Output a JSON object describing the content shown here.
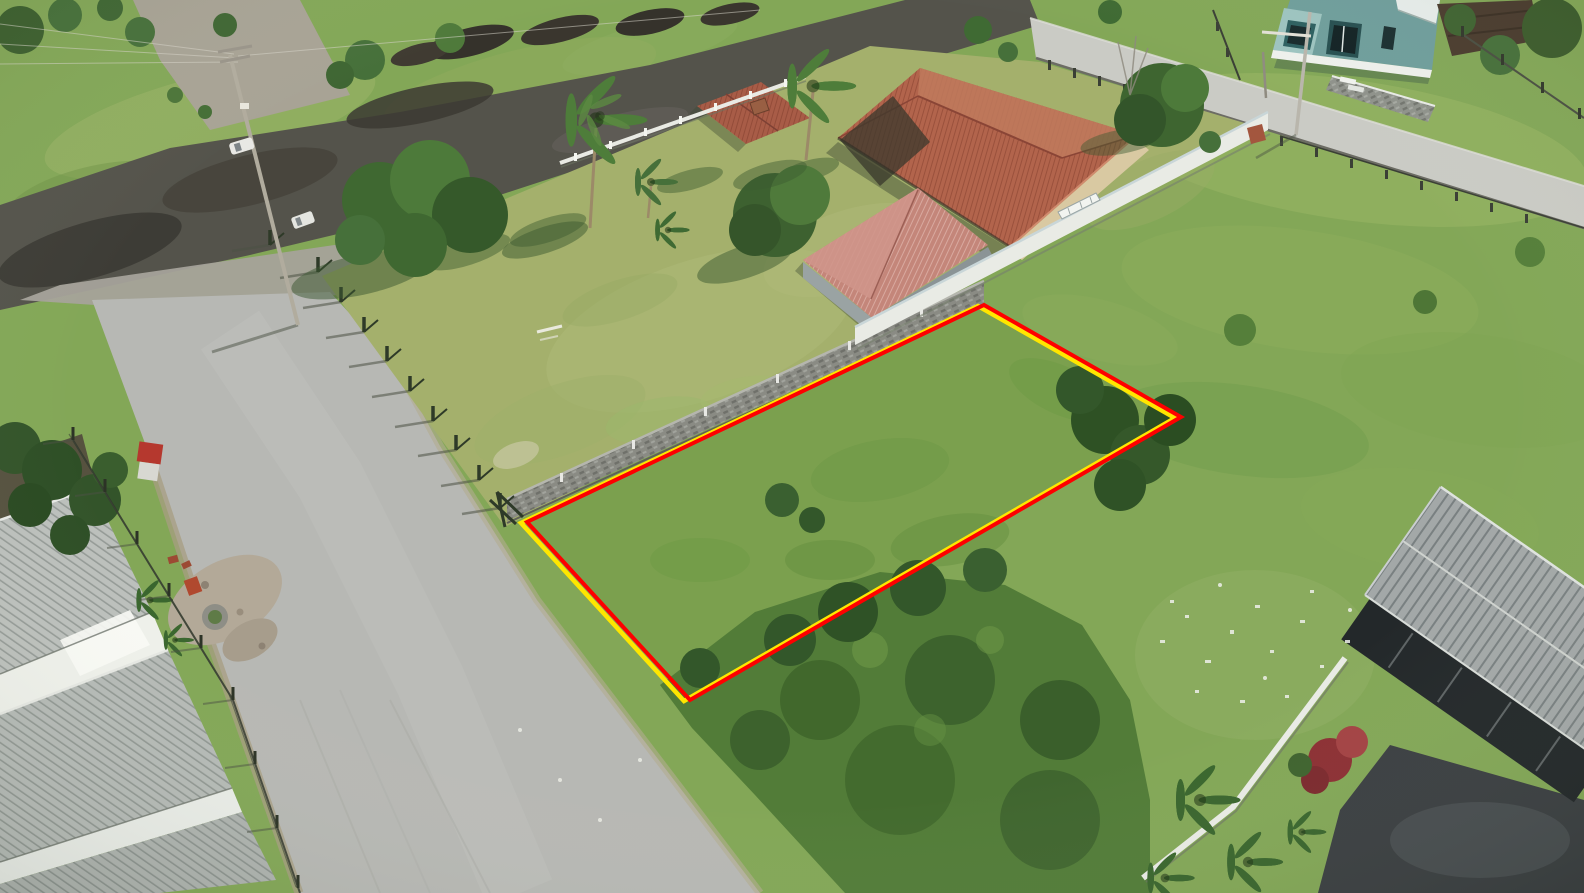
{
  "meta": {
    "type": "aerial-drone-photograph",
    "description": "Bright daytime aerial drone photo of a suburban block: a vacant grassy land plot is highlighted with a double red and yellow quadrilateral outline. A gray residential street runs diagonally past the plot, a dark asphalt road crosses the top, a cream house with terracotta tile roof and a red-roofed shed sit on a lawn behind a gray stone wall and a white wall, a teal modern house sits top-right by a concrete street, gray corrugated row buildings fill the bottom-left corner, and a dark-walled house with gray corrugated roof, driveway and red flowering bush sits bottom-right. Fields of mottled green grass and darker scrub fill the remaining areas.",
    "image_width_px": 1584,
    "image_height_px": 893,
    "visible_text": "none"
  },
  "plot_highlight": {
    "shape": "quadrilateral",
    "outer_line_color": "#ffe600",
    "inner_line_color": "#fe0000",
    "line_width_px": 4,
    "corners_px": {
      "top": [
        984,
        305
      ],
      "right": [
        1181,
        417
      ],
      "bottom": [
        690,
        700
      ],
      "left": [
        527,
        522
      ]
    }
  },
  "palette": {
    "grass_base": "#83a757",
    "field_light": "#9ab468",
    "lawn": "#a4b06c",
    "lot_grass": "#7ba04e",
    "scrub_dark": "#527c38",
    "asphalt_road": "#54534b",
    "street_gray": "#b7b8b4",
    "concrete_street": "#cacbc5",
    "gravel": "#a8a395",
    "dirt_shoulder": "#ab9f85",
    "terracotta_roof": "#b2644c",
    "annex_roof": "#a85c47",
    "shed_roof": "#c4867a",
    "shed_wall": "#9aa3a3",
    "cream_wall": "#d9c9a2",
    "white_wall": "#e9ebe5",
    "stone_wall": "#8a8b84",
    "teal_house": "#6f9e9c",
    "teal_trim": "#2d5f60",
    "gray_roof": "#a3a8a8",
    "rowhouse_roof": "#bcc0bc",
    "dark_facade": "#23282a",
    "driveway": "#3b3f42",
    "tree_dark": "#3f632f",
    "tree_mid": "#557f3c",
    "palm_green": "#4e7d3a",
    "red_bush": "#8c3034",
    "truck_red": "#b5382e",
    "vehicle_white": "#e8e8e4"
  },
  "scene": {
    "objects": [
      "highlighted-plot-outline",
      "vacant-plot",
      "asphalt-road",
      "gravel-road",
      "residential-street",
      "concrete-street",
      "field-top-left",
      "field-right",
      "scrub-vegetation",
      "yellow-house-lawn",
      "main-house",
      "annex-house",
      "storage-shed",
      "stone-boundary-wall",
      "white-boundary-wall",
      "gate-pillar",
      "white-front-fence",
      "teal-house",
      "terrace-wall",
      "rowhouses-bottom-left",
      "bottom-right-house",
      "driveway",
      "garden-white-wall",
      "roadside-fence-posts",
      "front-yard-fence",
      "utility-pole",
      "power-lines",
      "street-pole",
      "white-car",
      "white-van",
      "red-truck",
      "palm-trees",
      "shade-trees",
      "shrubs",
      "red-flower-bush",
      "debris-gravel-pile",
      "planter-pot",
      "round-planter",
      "trash-scatter",
      "dirt-piles",
      "dark-carport-structure"
    ]
  }
}
